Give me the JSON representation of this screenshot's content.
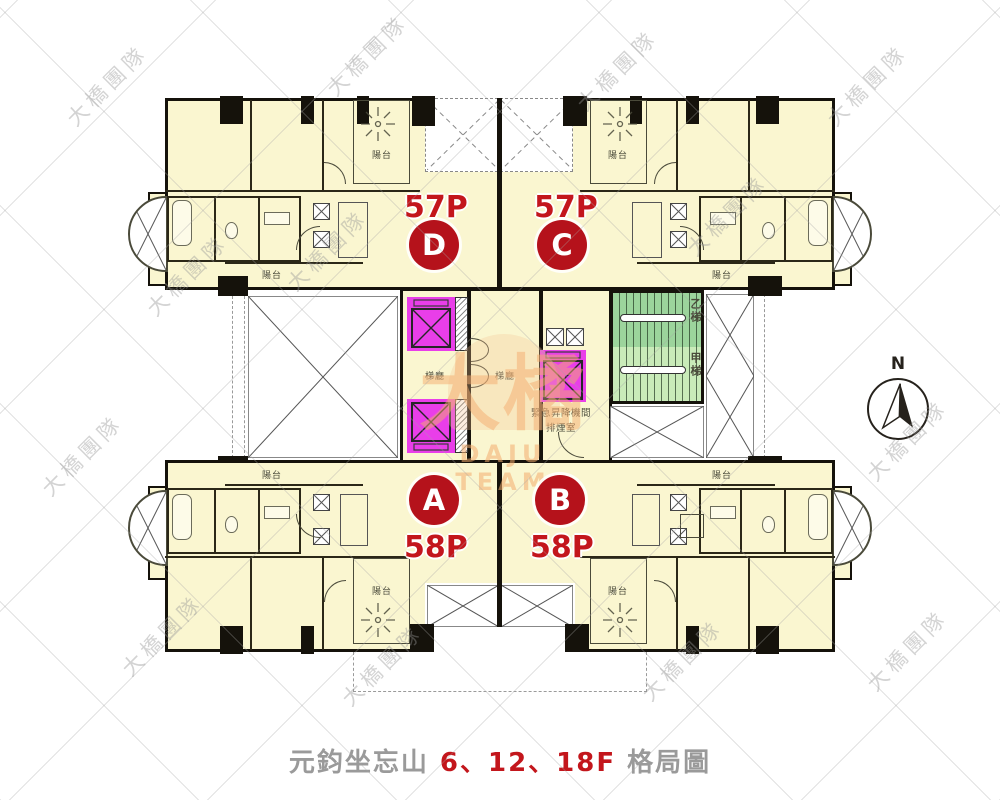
{
  "caption": {
    "project_name": "元鈞坐忘山",
    "floors": "6、12、18F",
    "suffix": "格局圖"
  },
  "compass": {
    "north_label": "N"
  },
  "units": [
    {
      "id": "D",
      "area_ping": "57P",
      "position": "upper-left"
    },
    {
      "id": "C",
      "area_ping": "57P",
      "position": "upper-right"
    },
    {
      "id": "A",
      "area_ping": "58P",
      "position": "lower-left"
    },
    {
      "id": "B",
      "area_ping": "58P",
      "position": "lower-right"
    }
  ],
  "core": {
    "elevator_lobby_label": "梯廳",
    "stair_b_label": "乙梯",
    "stair_a_label": "甲梯",
    "smoke_room_line1": "緊急昇降機間",
    "smoke_room_line2": "排煙室"
  },
  "labels": {
    "balcony": "陽台"
  },
  "watermark": {
    "diagonal_text": "大橋團隊",
    "logo_main": "大橘",
    "logo_sub": "DAJU TEAM"
  },
  "colors": {
    "unit_fill": "#FAF6D0",
    "wall": "#15120B",
    "elevator_magenta": "#E93EE9",
    "stair_upper_green": "#9CD49C",
    "stair_lower_green": "#C9EBB9",
    "unit_badge_red": "#B5121B",
    "accent_red": "#C3161C",
    "caption_gray": "#9A9A9A"
  }
}
